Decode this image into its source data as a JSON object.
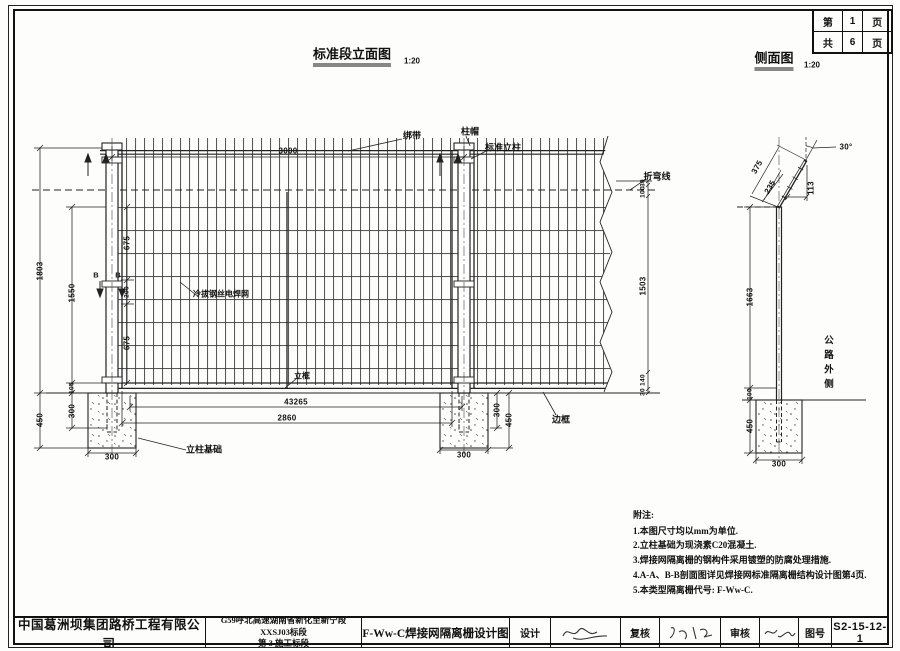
{
  "page_box": {
    "r1": [
      "第",
      "1",
      "页"
    ],
    "r2": [
      "共",
      "6",
      "页"
    ]
  },
  "titles": {
    "elevation": "标准段立面图",
    "elevation_scale": "1:20",
    "side": "侧面图",
    "side_scale": "1:20"
  },
  "elevation": {
    "labels": {
      "tie_band": "绑带",
      "post_cap": "柱帽",
      "standard_post": "标准立柱",
      "bend_line": "折弯线",
      "mesh": "冷拔钢丝电焊网",
      "vertical_frame": "立框",
      "edge_frame": "边框",
      "post_foundation": "立柱基础",
      "section_b_left": "B",
      "section_b_right": "B"
    },
    "dims": {
      "span": "3000",
      "total_height": "1803",
      "foundation_depth": "450",
      "mesh_height": "1550",
      "gap_100": "100",
      "embed_300": "300",
      "seg_675_top": "675",
      "seg_200": "200",
      "seg_675_bottom": "675",
      "right_30_top": "30",
      "right_100": "100",
      "right_1503": "1503",
      "right_140": "140",
      "right_30_bottom": "30",
      "length_43265": "43265",
      "frame_width": "2860",
      "foundation_width_left": "300",
      "foundation_width_right": "300",
      "right_embed_300": "300",
      "right_depth_450": "450"
    }
  },
  "side": {
    "labels": {
      "road_outside": "公路外侧"
    },
    "dims": {
      "angle": "30°",
      "arm_375": "375",
      "arm_235": "235",
      "offset_113": "113",
      "post_height": "1663",
      "gap_100": "100",
      "foundation_depth": "450",
      "foundation_width": "300"
    }
  },
  "notes": {
    "title": "附注:",
    "items": [
      "1.本图尺寸均以mm为单位.",
      "2.立柱基础为现浇素C20混凝土.",
      "3.焊接网隔离栅的钢构件采用镀塑的防腐处理措施.",
      "4.A-A、B-B剖面图详见焊接网标准隔离栅结构设计图第4页.",
      "5.本类型隔离栅代号: F-Ww-C."
    ]
  },
  "title_block": {
    "company": "中国葛洲坝集团路桥工程有限公司",
    "project_line1": "G59呼北高速湖南省新化至新宁段 XXSJ03标段",
    "project_line2": "第 3 施工标段",
    "drawing_title": "F-Ww-C焊接网隔离栅设计图",
    "design_label": "设计",
    "recheck_label": "复核",
    "review_label": "审核",
    "no_label": "图号",
    "drawing_no": "S2-15-12-1"
  }
}
